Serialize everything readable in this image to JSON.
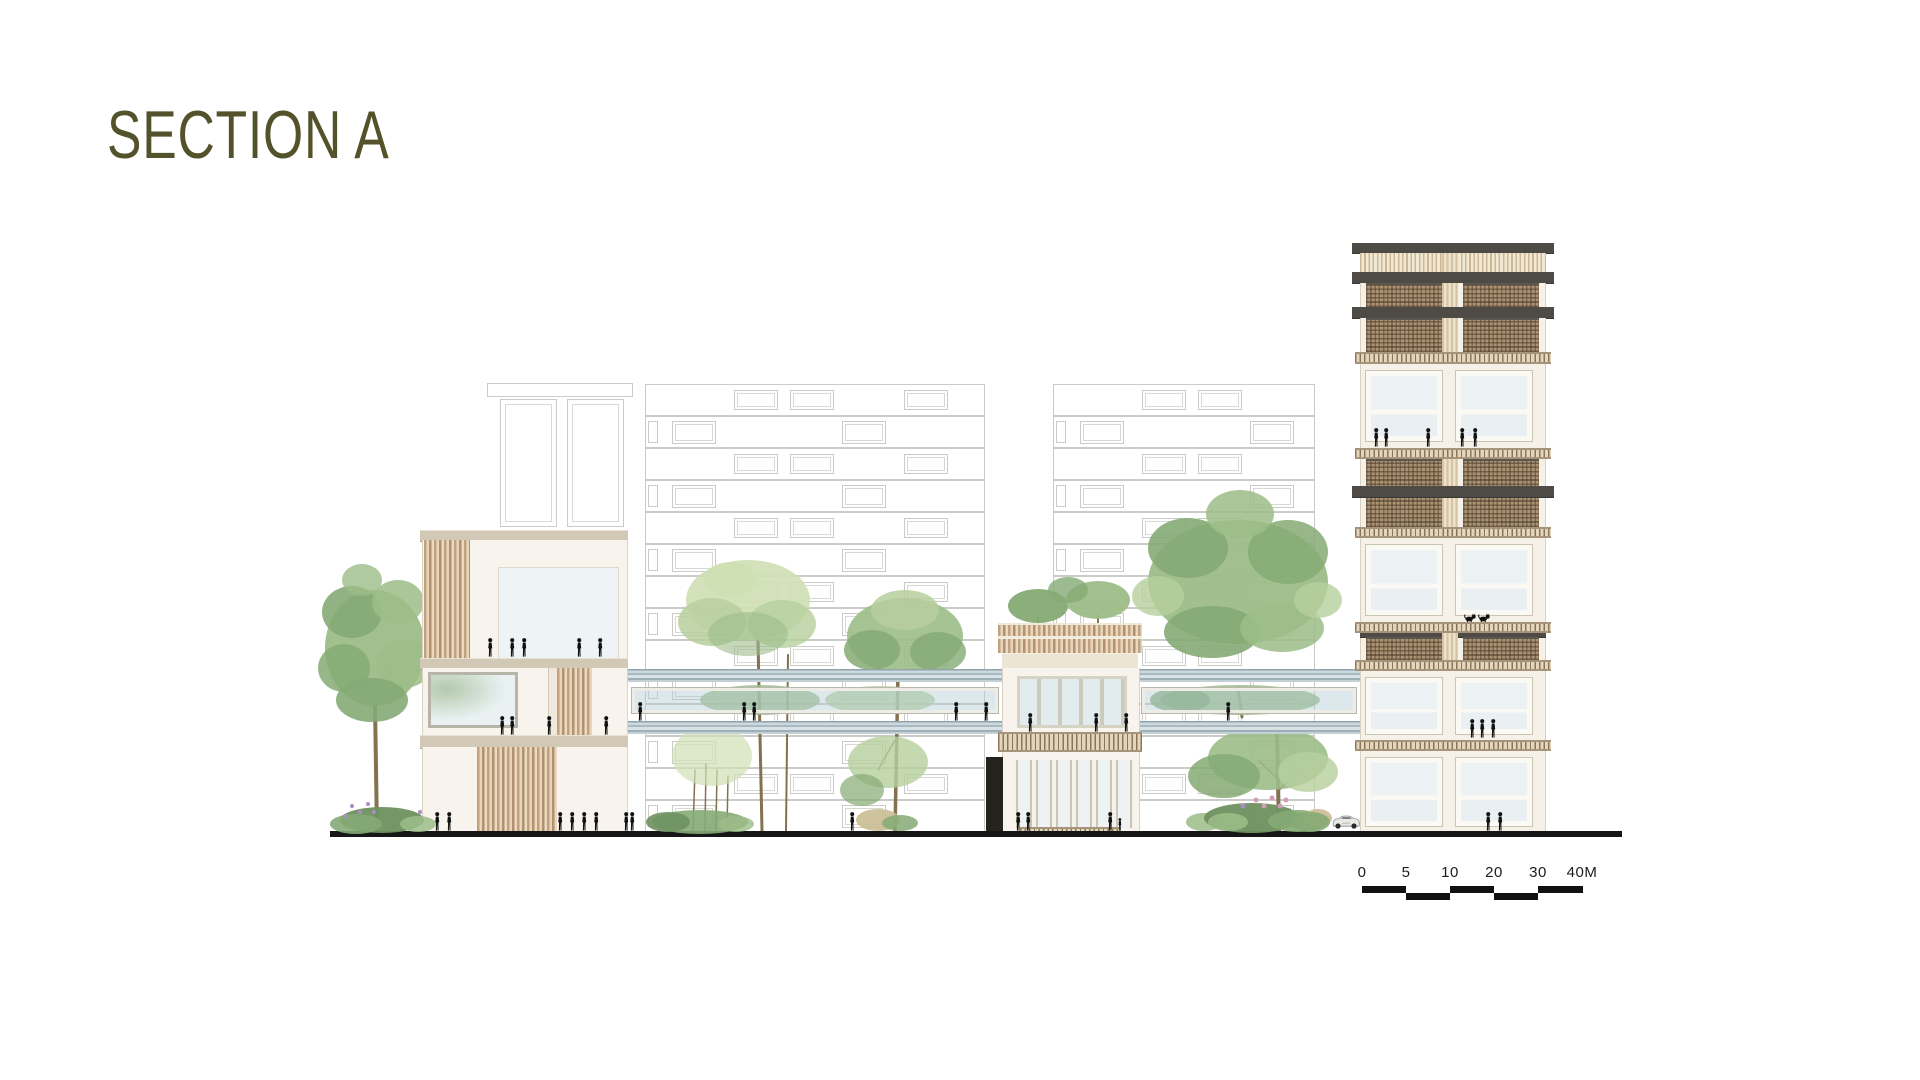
{
  "title": "SECTION A",
  "scale_bar": {
    "labels": [
      "0",
      "5",
      "10",
      "20",
      "30",
      "40M"
    ],
    "label_positions": [
      0,
      44,
      88,
      132,
      176,
      220
    ],
    "top_row_segments": [
      [
        0,
        44
      ],
      [
        88,
        44
      ],
      [
        176,
        45
      ]
    ],
    "bottom_row_segments": [
      [
        44,
        44
      ],
      [
        132,
        44
      ]
    ]
  },
  "palette": {
    "title_olive": "#53522a",
    "ground_black": "#161616",
    "concrete_beige": "#d1c9b5",
    "wood_slat": "#c2a181",
    "mesh_brown": "#ab9273",
    "dark_slab": "#4e4b46",
    "glass_blue": "#cfdfe6",
    "wall_cream": "#f7f2e9",
    "faint_line": "#98988f",
    "g1": "#b7cf9e",
    "g2": "#9cbd88",
    "g3": "#85aa74",
    "g4": "#cfdfb4",
    "g5": "#6e9160",
    "trunk": "#83714f",
    "tan": "#c9bd92",
    "pink": "#d49cb6",
    "violet": "#ab8cc6"
  },
  "bg_buildings": [
    {
      "x": 645,
      "y": 384,
      "w": 340,
      "rows": 14,
      "rowH": 32,
      "module": 170
    },
    {
      "x": 1053,
      "y": 384,
      "w": 262,
      "rows": 14,
      "rowH": 32,
      "module": 170
    }
  ],
  "bg_small_building": {
    "cornice": [
      487,
      383,
      146,
      14
    ],
    "panels": [
      [
        500,
        399,
        57,
        128
      ],
      [
        567,
        399,
        57,
        128
      ]
    ]
  },
  "tower": {
    "x": 1360,
    "w": 186,
    "bands": [
      {
        "t": "dark",
        "y": 243,
        "h": 10
      },
      {
        "t": "vslat",
        "y": 253,
        "h": 19
      },
      {
        "t": "dark",
        "y": 272,
        "h": 11
      },
      {
        "t": "mesh",
        "y": 283,
        "h": 24
      },
      {
        "t": "dark",
        "y": 307,
        "h": 11
      },
      {
        "t": "mesh",
        "y": 318,
        "h": 34
      },
      {
        "t": "hatch",
        "y": 352,
        "h": 12
      },
      {
        "t": "win",
        "y": 364,
        "h": 84,
        "wy": 371,
        "wh": 70
      },
      {
        "t": "hatch",
        "y": 448,
        "h": 11
      },
      {
        "t": "mesh2",
        "y": 459,
        "h": 68,
        "slabY": 486,
        "slabH": 11
      },
      {
        "t": "hatch",
        "y": 527,
        "h": 11
      },
      {
        "t": "win",
        "y": 538,
        "h": 84,
        "wy": 545,
        "wh": 70
      },
      {
        "t": "hatch",
        "y": 622,
        "h": 11
      },
      {
        "t": "mesh",
        "y": 633,
        "h": 27,
        "topline": true
      },
      {
        "t": "hatch",
        "y": 660,
        "h": 11
      },
      {
        "t": "win",
        "y": 671,
        "h": 69,
        "wy": 678,
        "wh": 56
      },
      {
        "t": "hatch",
        "y": 740,
        "h": 11
      },
      {
        "t": "win",
        "y": 751,
        "h": 81,
        "wy": 758,
        "wh": 68
      }
    ]
  },
  "trees": [
    {
      "name": "tree-left",
      "blobs": [
        [
          375,
          648,
          50,
          58,
          "g2",
          0.95
        ],
        [
          352,
          612,
          30,
          26,
          "g3",
          0.9
        ],
        [
          398,
          602,
          26,
          22,
          "g2",
          0.85
        ],
        [
          344,
          668,
          26,
          24,
          "g3",
          0.85
        ],
        [
          404,
          664,
          28,
          24,
          "g2",
          0.85
        ],
        [
          372,
          700,
          36,
          22,
          "g3",
          0.9
        ],
        [
          362,
          580,
          20,
          16,
          "g2",
          0.8
        ]
      ],
      "trunks": [
        [
          375,
          705,
          377,
          831,
          4
        ],
        [
          375,
          705,
          358,
          660,
          2
        ],
        [
          377,
          705,
          395,
          655,
          2
        ]
      ]
    },
    {
      "name": "tree-court-light",
      "blobs": [
        [
          748,
          600,
          62,
          40,
          "g4",
          0.92
        ],
        [
          712,
          622,
          34,
          24,
          "g1",
          0.85
        ],
        [
          782,
          624,
          34,
          24,
          "g1",
          0.8
        ],
        [
          748,
          634,
          40,
          22,
          "g2",
          0.6
        ],
        [
          730,
          580,
          26,
          18,
          "g4",
          0.85
        ],
        [
          760,
          700,
          60,
          15,
          "g2",
          0.8
        ],
        [
          712,
          756,
          40,
          30,
          "g4",
          0.7
        ]
      ],
      "trunks": [
        [
          758,
          640,
          762,
          831,
          3
        ],
        [
          788,
          655,
          786,
          831,
          2
        ],
        [
          695,
          770,
          693,
          831,
          1.5
        ],
        [
          706,
          764,
          705,
          831,
          1.5
        ],
        [
          717,
          770,
          716,
          831,
          1.5
        ],
        [
          728,
          776,
          727,
          831,
          1.5
        ]
      ]
    },
    {
      "name": "tree-court-mid",
      "blobs": [
        [
          905,
          636,
          58,
          38,
          "g2",
          0.9
        ],
        [
          872,
          650,
          28,
          20,
          "g3",
          0.85
        ],
        [
          938,
          652,
          28,
          20,
          "g3",
          0.8
        ],
        [
          905,
          610,
          34,
          20,
          "g1",
          0.85
        ],
        [
          880,
          700,
          55,
          14,
          "g1",
          0.8
        ],
        [
          888,
          762,
          40,
          26,
          "g1",
          0.8
        ],
        [
          862,
          790,
          22,
          16,
          "g3",
          0.7
        ]
      ],
      "trunks": [
        [
          898,
          672,
          895,
          831,
          3.5
        ],
        [
          895,
          740,
          878,
          770,
          1.5
        ]
      ]
    },
    {
      "name": "roof-trees",
      "blobs": [
        [
          1038,
          606,
          30,
          17,
          "g3",
          0.95
        ],
        [
          1098,
          600,
          32,
          19,
          "g2",
          0.95
        ],
        [
          1068,
          590,
          20,
          13,
          "g3",
          0.8
        ]
      ],
      "trunks": [
        [
          1038,
          618,
          1038,
          642,
          2
        ],
        [
          1098,
          614,
          1098,
          642,
          2
        ]
      ]
    },
    {
      "name": "tree-right-large",
      "blobs": [
        [
          1238,
          582,
          90,
          62,
          "g2",
          0.95
        ],
        [
          1188,
          548,
          40,
          30,
          "g3",
          0.9
        ],
        [
          1288,
          552,
          40,
          32,
          "g3",
          0.85
        ],
        [
          1212,
          632,
          48,
          26,
          "g3",
          0.9
        ],
        [
          1282,
          628,
          42,
          24,
          "g2",
          0.85
        ],
        [
          1240,
          514,
          34,
          24,
          "g2",
          0.85
        ],
        [
          1158,
          596,
          26,
          20,
          "g1",
          0.8
        ],
        [
          1318,
          600,
          24,
          18,
          "g1",
          0.8
        ],
        [
          1240,
          700,
          80,
          15,
          "g2",
          0.85
        ],
        [
          1180,
          700,
          30,
          12,
          "g3",
          0.8
        ],
        [
          1268,
          758,
          60,
          32,
          "g2",
          0.9
        ],
        [
          1224,
          776,
          36,
          22,
          "g3",
          0.85
        ],
        [
          1308,
          772,
          30,
          20,
          "g1",
          0.8
        ]
      ],
      "trunks": [
        [
          1238,
          688,
          1242,
          717,
          3
        ],
        [
          1277,
          733,
          1279,
          831,
          4
        ],
        [
          1279,
          790,
          1300,
          770,
          2
        ],
        [
          1279,
          780,
          1258,
          760,
          2
        ]
      ]
    }
  ],
  "vegetation": {
    "clumps": [
      [
        382,
        820,
        42,
        13,
        "g5",
        0.95
      ],
      [
        356,
        824,
        26,
        10,
        "g3",
        0.9
      ],
      [
        418,
        824,
        18,
        8,
        "g2",
        0.85
      ],
      [
        700,
        822,
        48,
        12,
        "g3",
        0.9
      ],
      [
        668,
        822,
        22,
        10,
        "g5",
        0.9
      ],
      [
        736,
        824,
        18,
        8,
        "g2",
        0.8
      ],
      [
        878,
        820,
        22,
        11,
        "tan",
        0.9
      ],
      [
        900,
        823,
        18,
        8,
        "g3",
        0.85
      ],
      [
        1204,
        822,
        18,
        9,
        "g2",
        0.85
      ],
      [
        1252,
        818,
        48,
        15,
        "g5",
        0.95
      ],
      [
        1298,
        821,
        30,
        11,
        "g3",
        0.9
      ],
      [
        1318,
        818,
        14,
        9,
        "tan",
        0.9
      ],
      [
        1228,
        822,
        20,
        9,
        "g2",
        0.85
      ],
      [
        1310,
        822,
        20,
        10,
        "g3",
        0.9
      ]
    ],
    "dots": [
      [
        352,
        806,
        2,
        "violet"
      ],
      [
        360,
        812,
        2,
        "violet"
      ],
      [
        368,
        804,
        2,
        "violet"
      ],
      [
        346,
        816,
        2,
        "violet"
      ],
      [
        374,
        812,
        2,
        "violet"
      ],
      [
        420,
        812,
        2,
        "violet"
      ],
      [
        1256,
        800,
        2.5,
        "pink"
      ],
      [
        1264,
        806,
        2.5,
        "pink"
      ],
      [
        1272,
        798,
        2.5,
        "pink"
      ],
      [
        1280,
        806,
        2.5,
        "pink"
      ],
      [
        1286,
        800,
        2.5,
        "pink"
      ],
      [
        1243,
        806,
        2.5,
        "violet"
      ]
    ]
  },
  "people": [
    [
      490,
      657
    ],
    [
      512,
      657
    ],
    [
      524,
      657
    ],
    [
      579,
      657
    ],
    [
      600,
      657
    ],
    [
      502,
      735
    ],
    [
      512,
      735
    ],
    [
      549,
      735
    ],
    [
      606,
      735
    ],
    [
      437,
      831
    ],
    [
      449,
      831
    ],
    [
      560,
      831
    ],
    [
      572,
      831
    ],
    [
      584,
      831
    ],
    [
      596,
      831
    ],
    [
      626,
      831
    ],
    [
      640,
      721
    ],
    [
      744,
      721
    ],
    [
      754,
      721
    ],
    [
      956,
      721
    ],
    [
      986,
      721
    ],
    [
      1030,
      732
    ],
    [
      1096,
      732
    ],
    [
      1126,
      732
    ],
    [
      1018,
      831
    ],
    [
      1028,
      831
    ],
    [
      1110,
      831
    ],
    [
      1120,
      831,
      13
    ],
    [
      632,
      831
    ],
    [
      852,
      831
    ],
    [
      1228,
      721
    ],
    [
      1376,
      447
    ],
    [
      1386,
      447
    ],
    [
      1428,
      447
    ],
    [
      1462,
      447
    ],
    [
      1475,
      447
    ],
    [
      1472,
      738
    ],
    [
      1482,
      738
    ],
    [
      1493,
      738
    ],
    [
      1488,
      831
    ],
    [
      1500,
      831
    ]
  ],
  "cats": [
    [
      1469,
      622
    ],
    [
      1483,
      622
    ]
  ],
  "car": {
    "x": 1331,
    "y": 812,
    "w": 30,
    "h": 20
  }
}
